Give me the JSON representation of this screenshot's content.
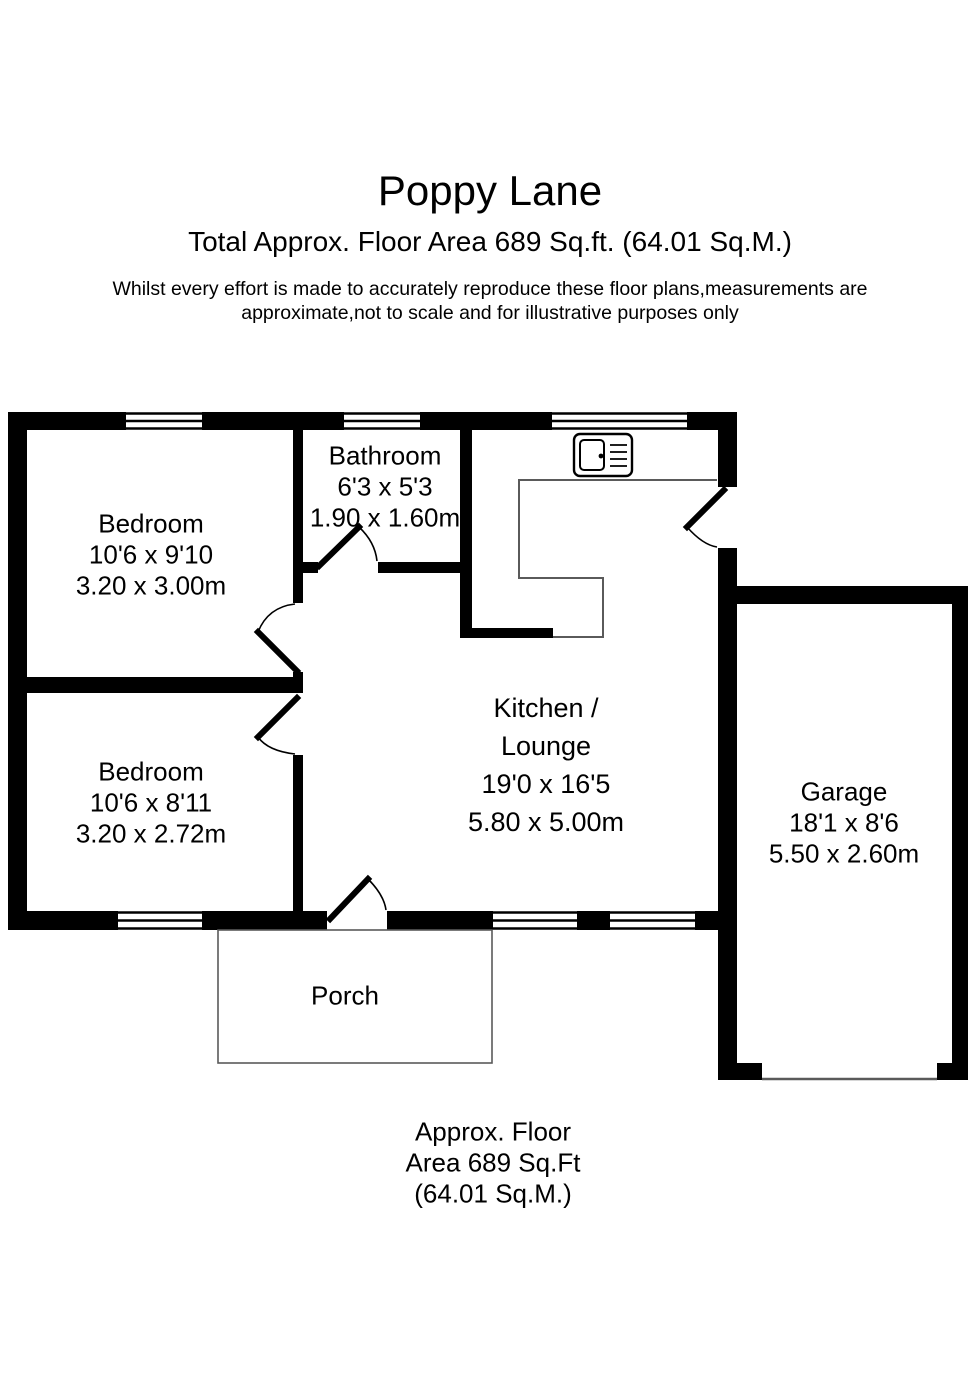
{
  "header": {
    "title": "Poppy Lane",
    "subtitle": "Total Approx. Floor Area 689 Sq.ft. (64.01 Sq.M.)",
    "disclaimer_line1": "Whilst every effort is made to accurately reproduce these floor plans,measurements are",
    "disclaimer_line2": "approximate,not to scale and for illustrative purposes only"
  },
  "rooms": {
    "bedroom1": {
      "name": "Bedroom",
      "imperial": "10'6 x 9'10",
      "metric": "3.20 x 3.00m"
    },
    "bathroom": {
      "name": "Bathroom",
      "imperial": "6'3 x 5'3",
      "metric": "1.90 x 1.60m"
    },
    "kitchen_lounge": {
      "name_line1": "Kitchen /",
      "name_line2": "Lounge",
      "imperial": "19'0 x 16'5",
      "metric": "5.80 x 5.00m"
    },
    "bedroom2": {
      "name": "Bedroom",
      "imperial": "10'6 x 8'11",
      "metric": "3.20 x 2.72m"
    },
    "garage": {
      "name": "Garage",
      "imperial": "18'1 x 8'6",
      "metric": "5.50 x 2.60m"
    },
    "porch": {
      "name": "Porch"
    }
  },
  "footer": {
    "line1": "Approx. Floor",
    "line2": "Area 689 Sq.Ft",
    "line3": "(64.01 Sq.M.)"
  },
  "colors": {
    "wall": "#000000",
    "thin_line": "#5a5a5a",
    "text": "#000000",
    "background": "#ffffff"
  }
}
